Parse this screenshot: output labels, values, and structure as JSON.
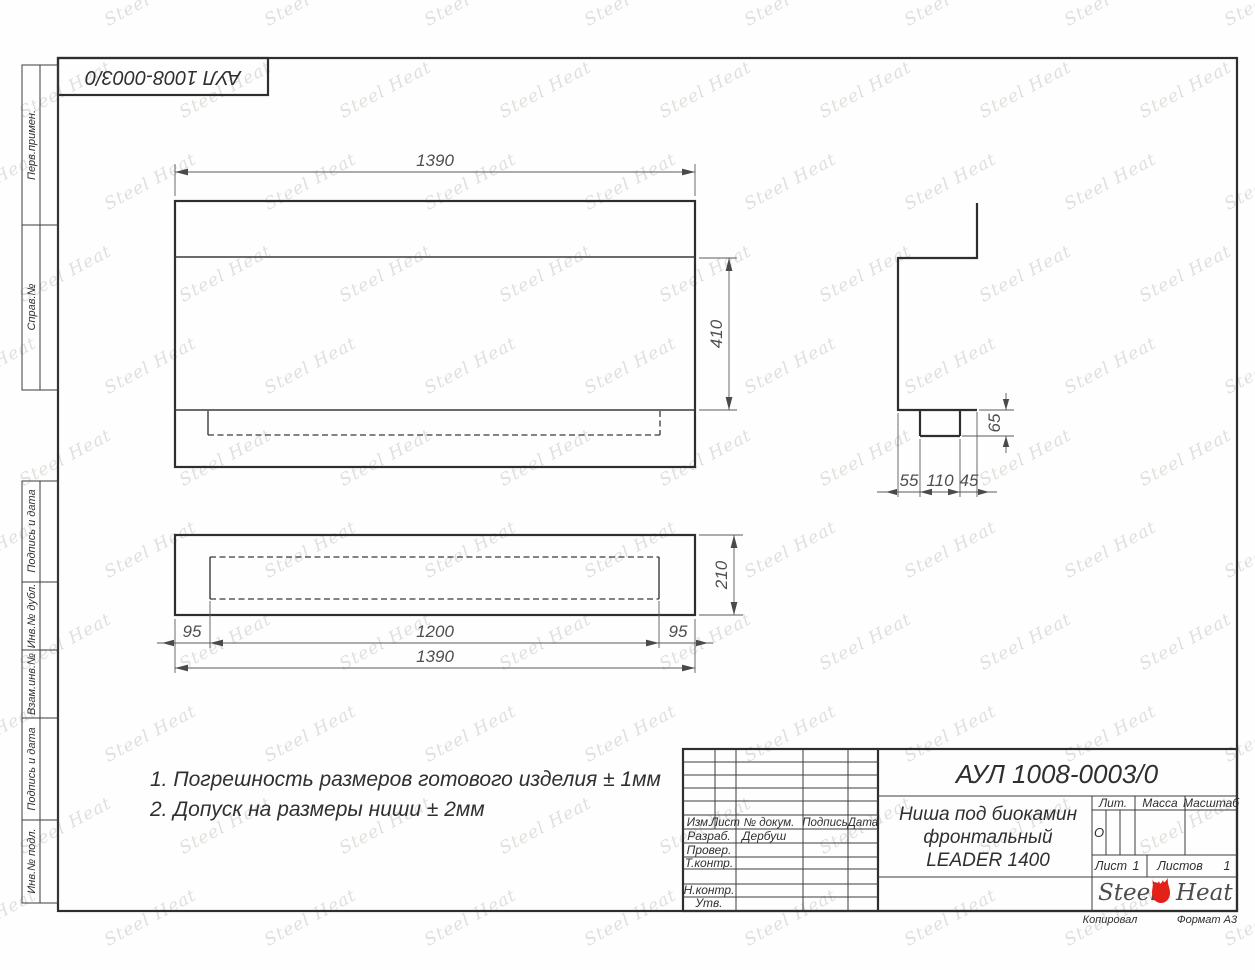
{
  "document": {
    "code": "АУЛ 1008-0003/0",
    "title_line1": "Ниша под биокамин",
    "title_line2": "фронтальный",
    "title_line3": "LEADER 1400",
    "copied_label": "Копировал",
    "format_label": "Формат А3"
  },
  "margin_boxes": [
    {
      "label": "Перв.примен."
    },
    {
      "label": "Справ.№"
    },
    {
      "label": "Подпись и дата"
    },
    {
      "label": "Инв.№ дубл."
    },
    {
      "label": "Взам.инв.№"
    },
    {
      "label": "Подпись и дата"
    },
    {
      "label": "Инв.№ подл."
    }
  ],
  "dimensions": {
    "front_width": "1390",
    "opening_height": "410",
    "plan_margin_left": "95",
    "plan_opening_width": "1200",
    "plan_margin_right": "95",
    "plan_total_width": "1390",
    "plan_depth": "210",
    "side_front_offset": "55",
    "side_slot_width": "110",
    "side_back_offset": "45",
    "side_slot_depth": "65"
  },
  "notes": {
    "line1": "1. Погрешность размеров готового изделия ± 1мм",
    "line2": "2. Допуск на размеры ниши ± 2мм"
  },
  "title_block": {
    "col_izm": "Изм.",
    "col_list": "Лист",
    "col_doc": "№ докум.",
    "col_sign": "Подпись",
    "col_date": "Дата",
    "developed_label": "Разраб.",
    "developed_value": "Дербуш",
    "checked_label": "Провер.",
    "tcontrol_label": "Т.контр.",
    "ncontrol_label": "Н.контр.",
    "approved_label": "Утв.",
    "lit_label": "Лит.",
    "lit_value": "О",
    "mass_label": "Масса",
    "scale_label": "Масштаб",
    "sheet_label": "Лист",
    "sheet_value": "1",
    "sheets_label": "Листов",
    "sheets_value": "1"
  },
  "logo": {
    "steel": "Steel",
    "heat": "Heat"
  },
  "watermark": {
    "text": "Steel Heat"
  },
  "colors": {
    "accent_red": "#e32119",
    "line_dark": "#2e2e2e",
    "watermark": "#ccd2ca"
  }
}
